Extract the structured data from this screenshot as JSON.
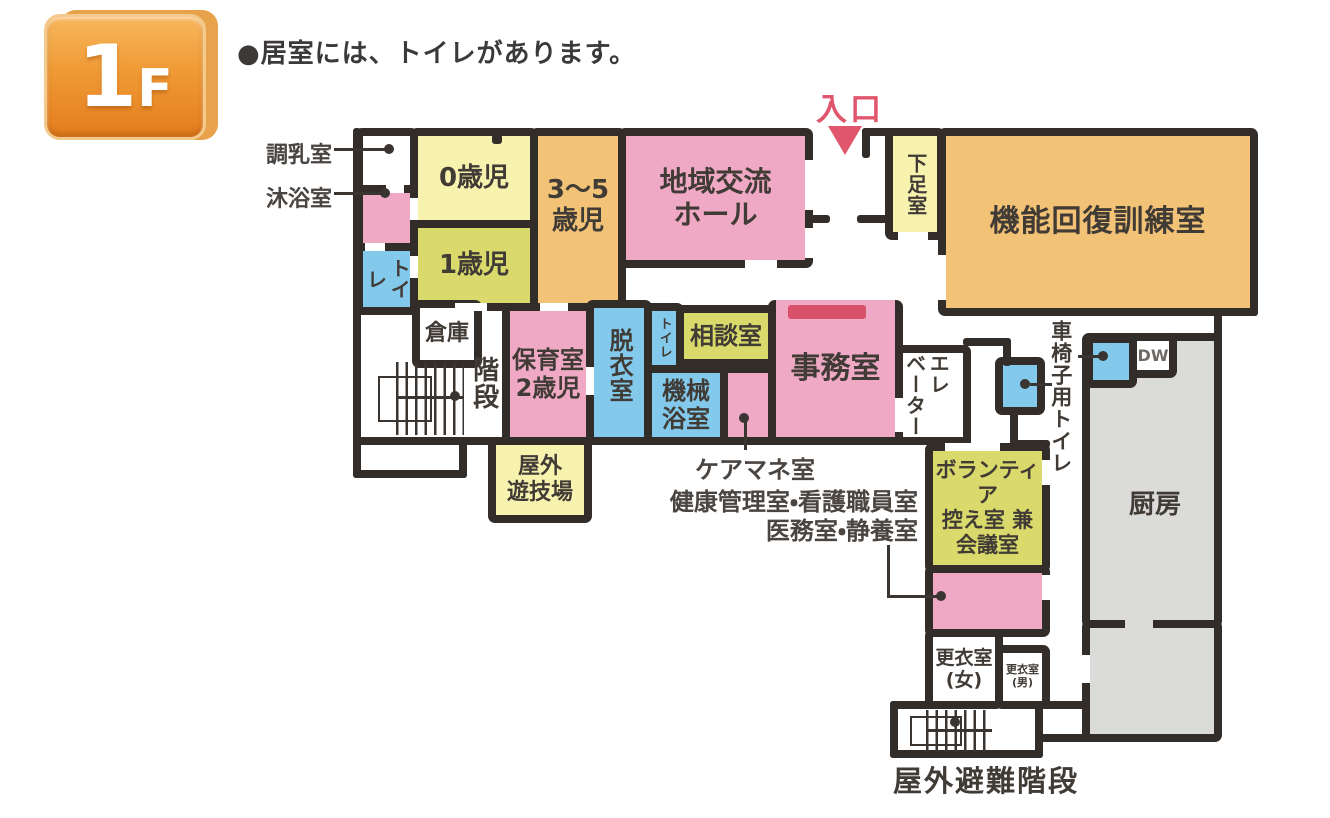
{
  "floor_badge": {
    "number": "1",
    "suffix": "F"
  },
  "note": "●居室には、トイレがあります。",
  "entrance": {
    "label": "入口"
  },
  "colors": {
    "wall": "#332d29",
    "pink": "#efa9c5",
    "pale_yellow": "#f7f2ae",
    "yellow_green": "#d9da6b",
    "orange": "#f2c277",
    "blue": "#83c9ec",
    "gray": "#dbdbda",
    "red_accent": "#e0566c",
    "badge_orange": "#ef9a34"
  },
  "rooms": {
    "milk_room": {
      "label": "調乳室"
    },
    "bathing_room": {
      "label": "沐浴室"
    },
    "toilet_left": {
      "label": "トイレ"
    },
    "nursery_0": {
      "label": "0歳児"
    },
    "nursery_1": {
      "label": "1歳児"
    },
    "nursery_3to5": {
      "line1": "3〜5",
      "line2": "歳児"
    },
    "community_hall": {
      "line1": "地域交流",
      "line2": "ホール"
    },
    "shoe_room": {
      "label": "下足室"
    },
    "rehab_room": {
      "label": "機能回復訓練室"
    },
    "storage": {
      "label": "倉庫"
    },
    "stairs": {
      "label": "階段"
    },
    "nursery_2": {
      "line1": "保育室",
      "line2": "2歳児"
    },
    "undressing_room": {
      "label": "脱衣室"
    },
    "toilet_small": {
      "label": "トイレ"
    },
    "machine_bath": {
      "line1": "機械",
      "line2": "浴室"
    },
    "consultation": {
      "label": "相談室"
    },
    "office": {
      "label": "事務室"
    },
    "elevator": {
      "col1": "エレ",
      "col2": "ベーター"
    },
    "playground": {
      "line1": "屋外",
      "line2": "遊技場"
    },
    "volunteer_room": {
      "line1": "ボランティア",
      "line2": "控え室 兼",
      "line3": "会議室"
    },
    "wheelchair_toilet": {
      "label": "車椅子用トイレ"
    },
    "dumbwaiter": {
      "label": "DW"
    },
    "kitchen": {
      "label": "厨房"
    },
    "locker_women": {
      "line1": "更衣室",
      "line2": "(女)"
    },
    "locker_men": {
      "line1": "更衣室",
      "line2": "(男)"
    }
  },
  "annotations": {
    "care_manager": "ケアマネ室",
    "health_nurse": "健康管理室・看護職員室",
    "medical_rest": "医務室・静養室",
    "outdoor_escape_stairs": "屋外避難階段"
  }
}
